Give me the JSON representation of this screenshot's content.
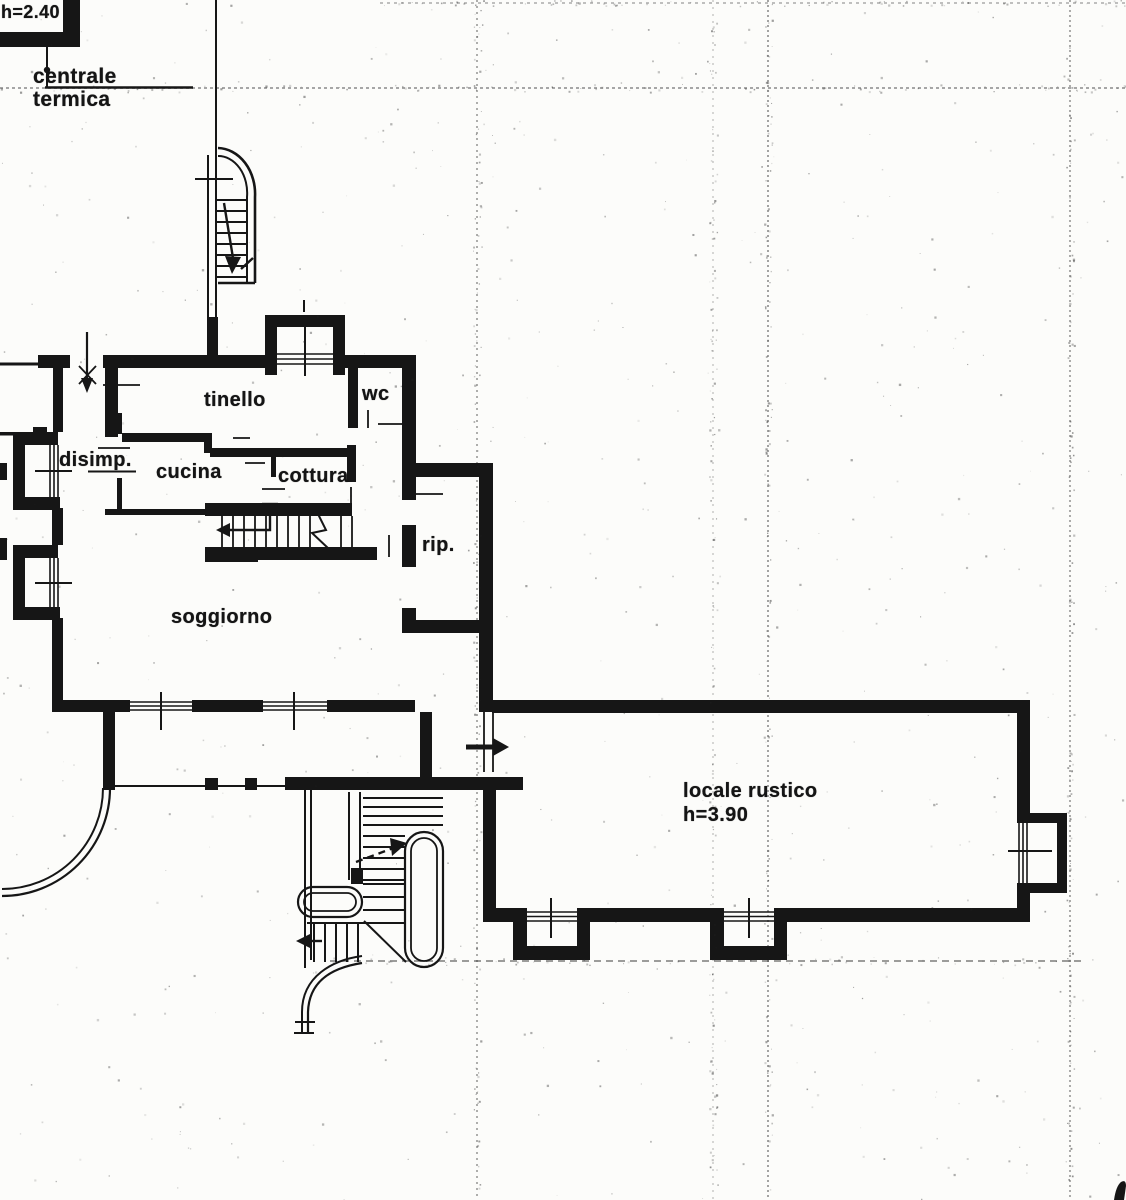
{
  "document": {
    "kind": "floor-plan (scanned blueprint)",
    "language": "italian"
  },
  "colors": {
    "ink": "#161616",
    "paper": "#fcfcfa",
    "fold_line": "#4a4a4a"
  },
  "annex": {
    "height_label": "h=2.40",
    "name_line1": "centrale",
    "name_line2": "termica"
  },
  "rooms": {
    "tinello": "tinello",
    "wc": "wc",
    "disimp": "disimp.",
    "cucina": "cucina",
    "cottura": "cottura",
    "rip": "rip.",
    "soggiorno": "soggiorno",
    "locale_rustico": "locale rustico",
    "locale_rustico_height": "h=3.90"
  },
  "icons": {
    "stair_up_arrows": "direction arrows on staircases",
    "entrance_arrows": "entry direction arrows"
  }
}
